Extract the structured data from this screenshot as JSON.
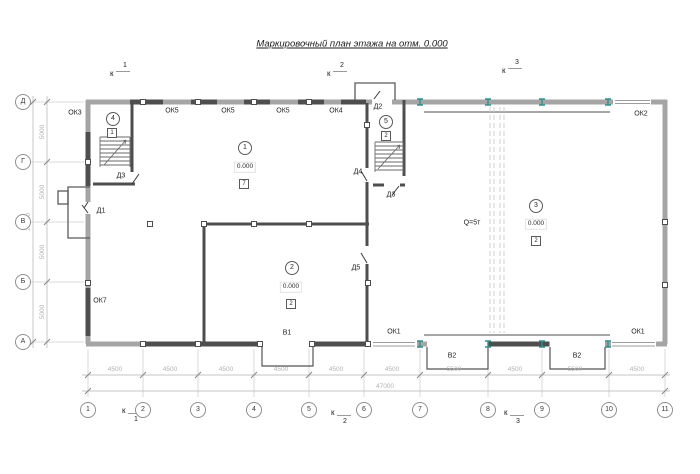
{
  "title": "Маркировочный план этажа на отм. 0.000",
  "grid": {
    "columns": [
      "1",
      "2",
      "3",
      "4",
      "5",
      "6",
      "7",
      "8",
      "9",
      "10",
      "11"
    ],
    "rows": [
      "Д",
      "Г",
      "В",
      "Б",
      "А"
    ]
  },
  "dimensions": {
    "bottom_spans": [
      "4500",
      "4500",
      "4500",
      "4500",
      "4500",
      "4500",
      "5500",
      "4500",
      "5500",
      "4500"
    ],
    "bottom_total": "47000",
    "left_spans": [
      "5000",
      "5000",
      "5000",
      "5000"
    ],
    "left_total": "20000"
  },
  "sections": {
    "letter": "к",
    "numbers": [
      "1",
      "2",
      "3"
    ]
  },
  "rooms": {
    "r1": {
      "number": "1",
      "elevation": "0.000",
      "floor_type": "7"
    },
    "r2": {
      "number": "2",
      "elevation": "0.000",
      "floor_type": "2"
    },
    "r3": {
      "number": "3",
      "elevation": "0.000",
      "floor_type": "2"
    },
    "r4": {
      "number": "4",
      "floor_type": "1"
    },
    "r5": {
      "number": "5",
      "floor_type": "2"
    }
  },
  "crane": {
    "capacity_label": "Q=5т"
  },
  "openings": {
    "windows": {
      "ok1": "ОК1",
      "ok2": "ОК2",
      "ok3": "ОК3",
      "ok4": "ОК4",
      "ok5": "ОК5",
      "ok7": "ОК7"
    },
    "doors": {
      "d1": "Д1",
      "d2": "Д2",
      "d3": "Д3",
      "d4": "Д4",
      "d5": "Д5"
    },
    "gates": {
      "v1": "В1",
      "v2": "В2"
    }
  },
  "colors": {
    "wall_grey": "#a5a5a5",
    "window_dark": "#4e4e4e",
    "crane_support_teal": "#2f9090",
    "dimension_grey": "#c4c4c4"
  }
}
